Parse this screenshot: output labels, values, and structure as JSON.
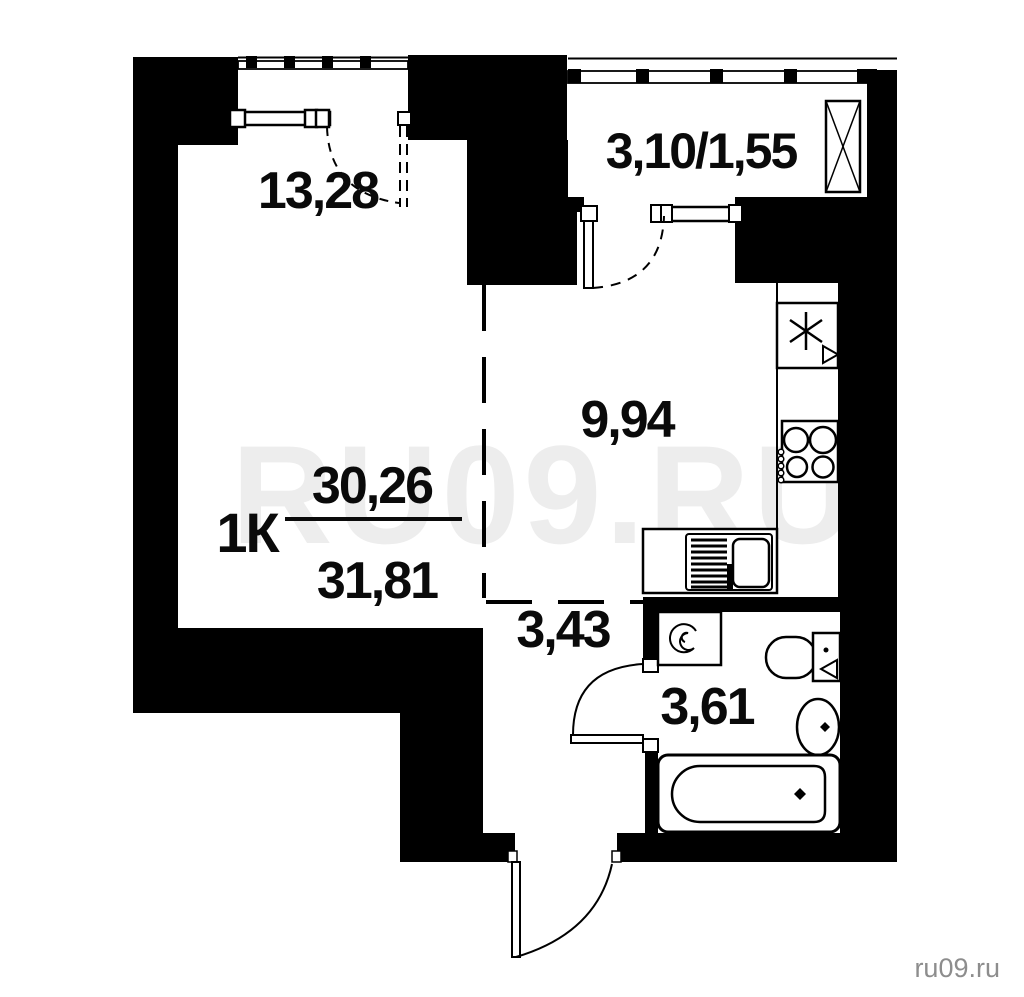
{
  "plan": {
    "unit_type": "1К",
    "area_fraction": {
      "upper": "30,26",
      "lower": "31,81"
    },
    "rooms": {
      "living_room": "13,28",
      "loggia": "3,10/1,55",
      "kitchen": "9,94",
      "hallway": "3,43",
      "bathroom": "3,61"
    },
    "watermark": "RU09.RU",
    "credit": "ru09.ru",
    "fixtures": [
      "fridge-icon",
      "stove-icon",
      "kitchen-sink-icon",
      "washing-machine-icon",
      "toilet-icon",
      "washbasin-icon",
      "bathtub-icon",
      "wardrobe-icon"
    ],
    "colors": {
      "wall": "#000000",
      "background": "#ffffff",
      "watermark": "#ededed",
      "credit": "#8d8d8d"
    }
  }
}
